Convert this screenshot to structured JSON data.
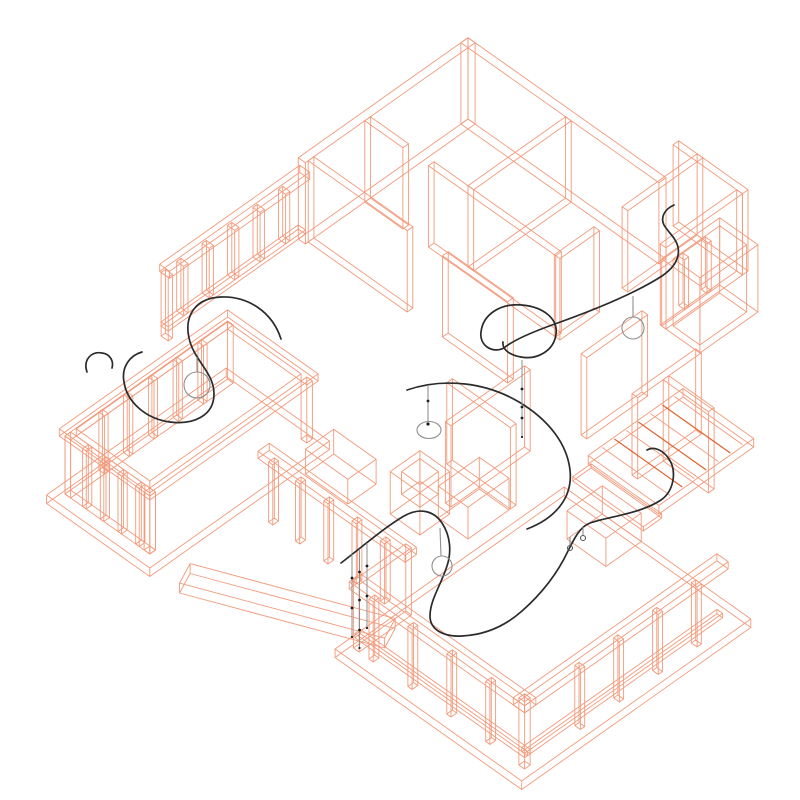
{
  "scene": {
    "width": 800,
    "height": 800,
    "background": "#ffffff",
    "description": "axonometric-wireframe-floor-plan-with-lighting-cable-curves-and-pendant-lamps"
  },
  "colors": {
    "background": "#ffffff",
    "wireframe": "#f29a7b",
    "wireframe_accent": "#e0622d",
    "curve": "#2b2b2b",
    "pendant": "#8f8f8f",
    "bead": "#1c1c1c"
  },
  "projection": {
    "cx": 468,
    "cy": 119,
    "kx": 0.7071,
    "ky": 0.5,
    "kz": 0.7071
  },
  "house": {
    "prisms": [
      {
        "name": "ne-wall",
        "box": [
          0,
          0,
          280,
          10
        ],
        "z": [
          0,
          115
        ]
      },
      {
        "name": "nw-wall",
        "box": [
          0,
          0,
          10,
          240
        ],
        "z": [
          0,
          115
        ]
      },
      {
        "name": "nw-window-head",
        "box": [
          -2,
          236,
          12,
          434
        ],
        "z": [
          90,
          100
        ]
      },
      {
        "name": "nw-window-sill",
        "box": [
          0,
          240,
          10,
          434
        ],
        "z": [
          14,
          20
        ]
      },
      {
        "name": "nw-mullion-1",
        "box": [
          0,
          262,
          10,
          268
        ],
        "z": [
          20,
          90
        ]
      },
      {
        "name": "nw-mullion-2",
        "box": [
          0,
          298,
          10,
          304
        ],
        "z": [
          20,
          90
        ]
      },
      {
        "name": "nw-mullion-3",
        "box": [
          0,
          334,
          10,
          340
        ],
        "z": [
          20,
          90
        ]
      },
      {
        "name": "nw-mullion-4",
        "box": [
          0,
          370,
          10,
          376
        ],
        "z": [
          20,
          90
        ]
      },
      {
        "name": "nw-mullion-5",
        "box": [
          0,
          406,
          10,
          412
        ],
        "z": [
          20,
          90
        ]
      },
      {
        "name": "nw-end-post",
        "box": [
          0,
          428,
          10,
          434
        ],
        "z": [
          0,
          90
        ]
      },
      {
        "name": "partition-a",
        "box": [
          148,
          10,
          156,
          148
        ],
        "z": [
          0,
          115
        ]
      },
      {
        "name": "partition-b",
        "box": [
          10,
          148,
          64,
          156
        ],
        "z": [
          0,
          115
        ]
      },
      {
        "name": "partition-c",
        "box": [
          100,
          148,
          280,
          156
        ],
        "z": [
          0,
          115
        ]
      },
      {
        "name": "corridor-wall-a",
        "box": [
          10,
          228,
          150,
          236
        ],
        "z": [
          0,
          115
        ]
      },
      {
        "name": "corridor-wall-b",
        "box": [
          200,
          228,
          292,
          236
        ],
        "z": [
          0,
          115
        ]
      },
      {
        "name": "wing-partition-a",
        "box": [
          278,
          -46,
          286,
          60
        ],
        "z": [
          0,
          115
        ]
      },
      {
        "name": "wing-partition-b",
        "box": [
          278,
          100,
          286,
          156
        ],
        "z": [
          0,
          115
        ]
      },
      {
        "name": "wing-ne-wall",
        "box": [
          252,
          -46,
          350,
          -38
        ],
        "z": [
          0,
          115
        ]
      },
      {
        "name": "wing-se-return",
        "box": [
          342,
          -38,
          350,
          70
        ],
        "z": [
          0,
          115
        ]
      },
      {
        "name": "balcony-outer",
        "box": [
          344,
          -12,
          398,
          70
        ],
        "z": [
          0,
          95
        ]
      },
      {
        "name": "balcony-inner",
        "box": [
          352,
          -4,
          390,
          62
        ],
        "z": [
          0,
          95
        ]
      },
      {
        "name": "balcony-mullion-1",
        "box": [
          344,
          8,
          352,
          14
        ],
        "z": [
          12,
          82
        ]
      },
      {
        "name": "balcony-mullion-2",
        "box": [
          344,
          40,
          352,
          46
        ],
        "z": [
          12,
          82
        ]
      },
      {
        "name": "interior-wall-a",
        "box": [
          472,
          150,
          480,
          240
        ],
        "z": [
          0,
          115
        ]
      },
      {
        "name": "interior-wall-b",
        "box": [
          480,
          196,
          544,
          204
        ],
        "z": [
          0,
          115
        ]
      },
      {
        "name": "interior-wall-c",
        "box": [
          396,
          150,
          404,
          236
        ],
        "z": [
          0,
          115
        ]
      },
      {
        "name": "core-wall-a",
        "box": [
          368,
          288,
          376,
          400
        ],
        "z": [
          0,
          115
        ]
      },
      {
        "name": "core-wall-b",
        "box": [
          330,
          352,
          420,
          360
        ],
        "z": [
          0,
          115
        ]
      },
      {
        "name": "cabinet",
        "box": [
          378,
          362,
          420,
          420
        ],
        "z": [
          0,
          45
        ]
      },
      {
        "name": "fireplace",
        "box": [
          340,
          408,
          382,
          450
        ],
        "z": [
          0,
          60
        ]
      },
      {
        "name": "fireplace-inner",
        "box": [
          348,
          416,
          374,
          442
        ],
        "z": [
          28,
          60
        ]
      },
      {
        "name": "low-box",
        "box": [
          490,
          300,
          545,
          350
        ],
        "z": [
          0,
          40
        ]
      },
      {
        "name": "living-window-head",
        "box": [
          251,
          532,
          459,
          548
        ],
        "z": [
          85,
          95
        ]
      },
      {
        "name": "living-mullion-1",
        "box": [
          262,
          536,
          268,
          544
        ],
        "z": [
          0,
          85
        ]
      },
      {
        "name": "living-mullion-2",
        "box": [
          300,
          536,
          306,
          544
        ],
        "z": [
          0,
          85
        ]
      },
      {
        "name": "living-mullion-3",
        "box": [
          340,
          536,
          346,
          544
        ],
        "z": [
          0,
          85
        ]
      },
      {
        "name": "living-mullion-4",
        "box": [
          380,
          536,
          386,
          544
        ],
        "z": [
          0,
          85
        ]
      },
      {
        "name": "living-mullion-5",
        "box": [
          420,
          536,
          426,
          544
        ],
        "z": [
          0,
          85
        ]
      },
      {
        "name": "step-wall",
        "box": [
          448,
          536,
          456,
          610
        ],
        "z": [
          0,
          95
        ]
      },
      {
        "name": "porch-sw-head",
        "box": [
          446,
          598,
          694,
          614
        ],
        "z": [
          85,
          95
        ]
      },
      {
        "name": "porch-sw-mullion-1",
        "box": [
          470,
          602,
          476,
          610
        ],
        "z": [
          0,
          85
        ]
      },
      {
        "name": "porch-sw-mullion-2",
        "box": [
          525,
          602,
          531,
          610
        ],
        "z": [
          0,
          85
        ]
      },
      {
        "name": "porch-sw-mullion-3",
        "box": [
          580,
          602,
          586,
          610
        ],
        "z": [
          0,
          85
        ]
      },
      {
        "name": "porch-sw-mullion-4",
        "box": [
          635,
          602,
          641,
          610
        ],
        "z": [
          0,
          85
        ]
      },
      {
        "name": "porch-corner-post",
        "box": [
          682,
          602,
          690,
          610
        ],
        "z": [
          0,
          95
        ]
      },
      {
        "name": "porch-se-head",
        "box": [
          678,
          326,
          694,
          614
        ],
        "z": [
          85,
          95
        ]
      },
      {
        "name": "porch-se-mullion-1",
        "box": [
          682,
          360,
          690,
          366
        ],
        "z": [
          0,
          85
        ]
      },
      {
        "name": "porch-se-mullion-2",
        "box": [
          682,
          415,
          690,
          421
        ],
        "z": [
          0,
          85
        ]
      },
      {
        "name": "porch-se-mullion-3",
        "box": [
          682,
          470,
          690,
          476
        ],
        "z": [
          0,
          85
        ]
      },
      {
        "name": "porch-se-mullion-4",
        "box": [
          682,
          525,
          690,
          531
        ],
        "z": [
          0,
          85
        ]
      },
      {
        "name": "porch-sw-sill",
        "box": [
          450,
          602,
          690,
          610
        ],
        "z": [
          16,
          22
        ]
      },
      {
        "name": "porch-se-sill",
        "box": [
          682,
          330,
          690,
          606
        ],
        "z": [
          16,
          22
        ]
      },
      {
        "name": "deck",
        "box": [
          430,
          126,
          530,
          260
        ],
        "z": [
          0,
          12
        ]
      },
      {
        "name": "deck-step",
        "box": [
          436,
          262,
          536,
          288
        ],
        "z": [
          0,
          6
        ]
      },
      {
        "name": "terrace-head-outer",
        "box": [
          86,
          426,
          214,
          664
        ],
        "z": [
          82,
          92
        ]
      },
      {
        "name": "terrace-head-inner",
        "box": [
          98,
          438,
          202,
          652
        ],
        "z": [
          82,
          92
        ]
      },
      {
        "name": "terrace-nw-wall",
        "box": [
          90,
          430,
          98,
          660
        ],
        "z": [
          0,
          82
        ]
      },
      {
        "name": "terrace-sw-wall",
        "box": [
          90,
          652,
          210,
          660
        ],
        "z": [
          0,
          82
        ]
      },
      {
        "name": "terrace-post-a",
        "box": [
          202,
          430,
          210,
          438
        ],
        "z": [
          0,
          82
        ]
      },
      {
        "name": "terrace-post-b",
        "box": [
          202,
          652,
          210,
          660
        ],
        "z": [
          0,
          82
        ]
      },
      {
        "name": "terrace-nw-mullion-1",
        "box": [
          90,
          467,
          98,
          472
        ],
        "z": [
          0,
          82
        ]
      },
      {
        "name": "terrace-nw-mullion-2",
        "box": [
          90,
          502,
          98,
          507
        ],
        "z": [
          0,
          82
        ]
      },
      {
        "name": "terrace-nw-mullion-3",
        "box": [
          90,
          537,
          98,
          542
        ],
        "z": [
          0,
          82
        ]
      },
      {
        "name": "terrace-nw-mullion-4",
        "box": [
          90,
          572,
          98,
          577
        ],
        "z": [
          0,
          82
        ]
      },
      {
        "name": "terrace-nw-mullion-5",
        "box": [
          90,
          607,
          98,
          612
        ],
        "z": [
          0,
          82
        ]
      },
      {
        "name": "terrace-sw-mullion-1",
        "box": [
          115,
          652,
          120,
          660
        ],
        "z": [
          0,
          82
        ]
      },
      {
        "name": "terrace-sw-mullion-2",
        "box": [
          140,
          652,
          145,
          660
        ],
        "z": [
          0,
          82
        ]
      },
      {
        "name": "terrace-sw-mullion-3",
        "box": [
          165,
          652,
          170,
          660
        ],
        "z": [
          0,
          82
        ]
      },
      {
        "name": "terrace-sw-mullion-4",
        "box": [
          190,
          652,
          195,
          660
        ],
        "z": [
          0,
          82
        ]
      },
      {
        "name": "terrace-plinth",
        "box": [
          78,
          420,
          224,
          674
        ],
        "z": [
          -12,
          0
        ]
      },
      {
        "name": "front-plinth",
        "box": [
          436,
          300,
          700,
          624
        ],
        "z": [
          -12,
          0
        ]
      },
      {
        "name": "bench",
        "box": [
          240,
          430,
          300,
          470
        ],
        "z": [
          0,
          35
        ]
      },
      {
        "name": "ramp",
        "pts": [
          [
            258,
            651
          ],
          [
            458,
            561
          ],
          [
            470,
            588
          ],
          [
            270,
            678
          ]
        ],
        "z": [
          0,
          14
        ]
      }
    ],
    "slats": {
      "z": 12,
      "x": [
        432,
        528
      ],
      "ys": [
        140,
        157,
        174,
        191,
        208,
        225,
        242
      ],
      "accent_ys": [
        157,
        191,
        225
      ]
    }
  },
  "lighting": {
    "curves": [
      {
        "name": "cable-left-s",
        "d": "M 281,339 C 272,311 247,296 221,297 C 196,298 184,315 189,338 C 194,361 214,372 214,394 C 214,416 193,425 170,422 C 147,419 127,403 124,382 C 121,366 131,355 142,352"
      },
      {
        "name": "cable-left-hook",
        "d": "M 87,372 C 83,360 91,351 102,353 C 110,354 114,361 112,368"
      },
      {
        "name": "cable-right-long-loop",
        "d": "M 674,205 C 665,209 660,217 664,225 C 668,232 676,238 678,247 C 680,257 675,267 662,276 C 634,294 589,312 552,325 C 530,333 512,341 504,348 C 492,354 479,345 481,332 C 483,314 501,303 522,305 C 544,307 558,319 556,334 C 554,351 537,360 521,357 C 509,355 502,349 503,342"
      },
      {
        "name": "cable-center-arc",
        "d": "M 407,390 C 445,377 487,383 519,402 C 549,420 567,444 570,470 C 573,497 556,518 527,529"
      },
      {
        "name": "cable-porch-wave",
        "d": "M 341,563 C 362,547 385,527 404,516 C 420,507 434,511 442,523 C 450,535 452,551 447,566 C 441,585 430,600 430,616 C 430,630 444,637 462,636 C 483,635 504,627 522,611 C 547,589 560,568 568,551 C 575,537 580,527 590,523 C 606,517 640,514 661,500 C 674,491 677,471 669,459 C 663,450 654,446 647,450"
      }
    ],
    "pendant_stems": [
      [
        197,
        357,
        197,
        372
      ],
      [
        633,
        296,
        633,
        317
      ],
      [
        428,
        385,
        428,
        421
      ],
      [
        440,
        528,
        441,
        556
      ],
      [
        570,
        537,
        570,
        545
      ],
      [
        583,
        527,
        583,
        535
      ]
    ],
    "pendant_circles": [
      {
        "c": [
          197,
          385
        ],
        "r": 13
      },
      {
        "c": [
          633,
          328
        ],
        "r": 11
      },
      {
        "c": [
          442,
          566
        ],
        "r": 10
      },
      {
        "c": [
          570,
          548
        ],
        "r": 2.5
      },
      {
        "c": [
          583,
          538
        ],
        "r": 2.5
      }
    ],
    "pendant_ellipses": [
      {
        "c": [
          429,
          430
        ],
        "rx": 12,
        "ry": 8.5
      }
    ],
    "drop_lines": [
      {
        "x": 522,
        "y1": 360,
        "y2": 437,
        "beads": [
          389,
          407,
          418
        ]
      },
      {
        "x": 352,
        "y1": 554,
        "y2": 637,
        "beads": [
          578,
          608
        ]
      },
      {
        "x": 359.5,
        "y1": 549,
        "y2": 648,
        "beads": [
          572,
          600,
          630
        ]
      },
      {
        "x": 367,
        "y1": 543,
        "y2": 628,
        "beads": [
          566,
          596
        ]
      }
    ],
    "beads": [
      {
        "c": [
          428,
          401
        ],
        "r": 1.4
      },
      {
        "c": [
          428,
          424
        ],
        "r": 1.6
      }
    ]
  }
}
